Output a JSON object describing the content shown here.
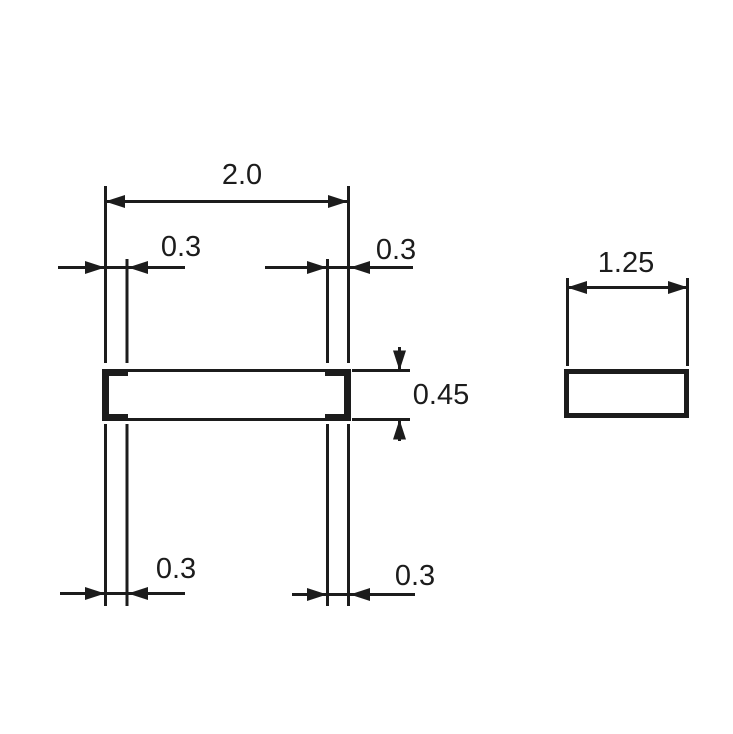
{
  "drawing": {
    "front_view": {
      "width_label": "2.0",
      "terminal_top_left_label": "0.3",
      "terminal_top_right_label": "0.3",
      "height_label": "0.45",
      "terminal_bottom_left_label": "0.3",
      "terminal_bottom_right_label": "0.3"
    },
    "side_view": {
      "width_label": "1.25"
    },
    "colors": {
      "ink": "#1c1c1c",
      "background": "#ffffff"
    }
  }
}
